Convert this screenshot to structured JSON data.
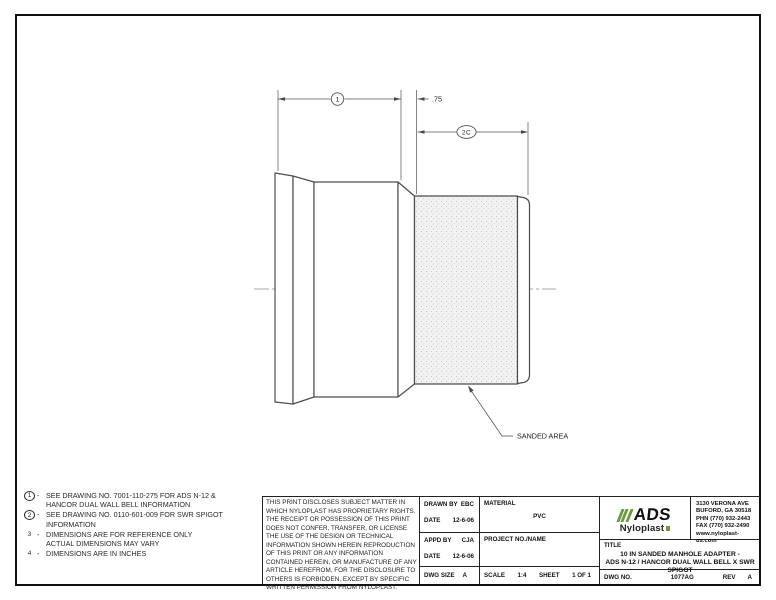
{
  "notes": {
    "dash": "-",
    "items": [
      {
        "num": "1",
        "line1": "SEE DRAWING NO. 7001-110-275 FOR ADS N-12 &",
        "line2": "HANCOR DUAL WALL BELL INFORMATION"
      },
      {
        "num": "2",
        "line1": "SEE DRAWING NO. 0110-601-009 FOR SWR SPIGOT",
        "line2": "INFORMATION"
      },
      {
        "num": "3",
        "line1": "DIMENSIONS ARE FOR REFERENCE ONLY",
        "line2": "ACTUAL DIMENSIONS MAY VARY"
      },
      {
        "num": "4",
        "line1": "DIMENSIONS ARE IN INCHES",
        "line2": ""
      }
    ]
  },
  "drawing": {
    "dim1_label": "1",
    "dim2_label": "2C",
    "chamfer_dim": ".75",
    "sanded_callout": "SANDED AREA"
  },
  "title_block": {
    "disclaimer": "THIS PRINT DISCLOSES SUBJECT MATTER IN WHICH NYLOPLAST HAS PROPRIETARY RIGHTS.  THE RECEIPT OR POSSESSION OF THIS PRINT DOES NOT CONFER, TRANSFER, OR LICENSE THE USE OF THE DESIGN OR TECHNICAL INFORMATION SHOWN HEREIN REPRODUCTION OF THIS PRINT OR ANY INFORMATION CONTAINED HEREIN, OR MANUFACTURE OF ANY ARTICLE HEREFROM, FOR THE DISCLOSURE TO OTHERS IS FORBIDDEN, EXCEPT BY SPECIFIC WRITTEN PERMISSION FROM NYLOPLAST.",
    "drawn_by_label": "DRAWN BY",
    "drawn_by": "EBC",
    "date_label": "DATE",
    "drawn_date": "12-6-06",
    "appd_by_label": "APPD BY",
    "appd_by": "CJA",
    "appd_date": "12-6-06",
    "dwg_size_label": "DWG SIZE",
    "dwg_size": "A",
    "material_label": "MATERIAL",
    "material": "PVC",
    "project_label": "PROJECT NO./NAME",
    "scale_label": "SCALE",
    "scale": "1:4",
    "sheet_label": "SHEET",
    "sheet": "1 OF 1",
    "title_label": "TITLE",
    "title_line1": "10 IN SANDED MANHOLE ADAPTER -",
    "title_line2": "ADS N-12 / HANCOR DUAL WALL BELL X SWR SPIGOT",
    "dwg_no_label": "DWG NO.",
    "dwg_no": "1077AG",
    "rev_label": "REV",
    "rev": "A"
  },
  "logo": {
    "brand": "ADS",
    "sub_brand": "Nyloplast",
    "green": "#6a9a3b",
    "address_lines": [
      "3130 VERONA AVE",
      "BUFORD, GA 30518",
      "PHN (770) 932-2443",
      "FAX (770) 932-2490",
      "www.nyloplast-us.com"
    ]
  }
}
